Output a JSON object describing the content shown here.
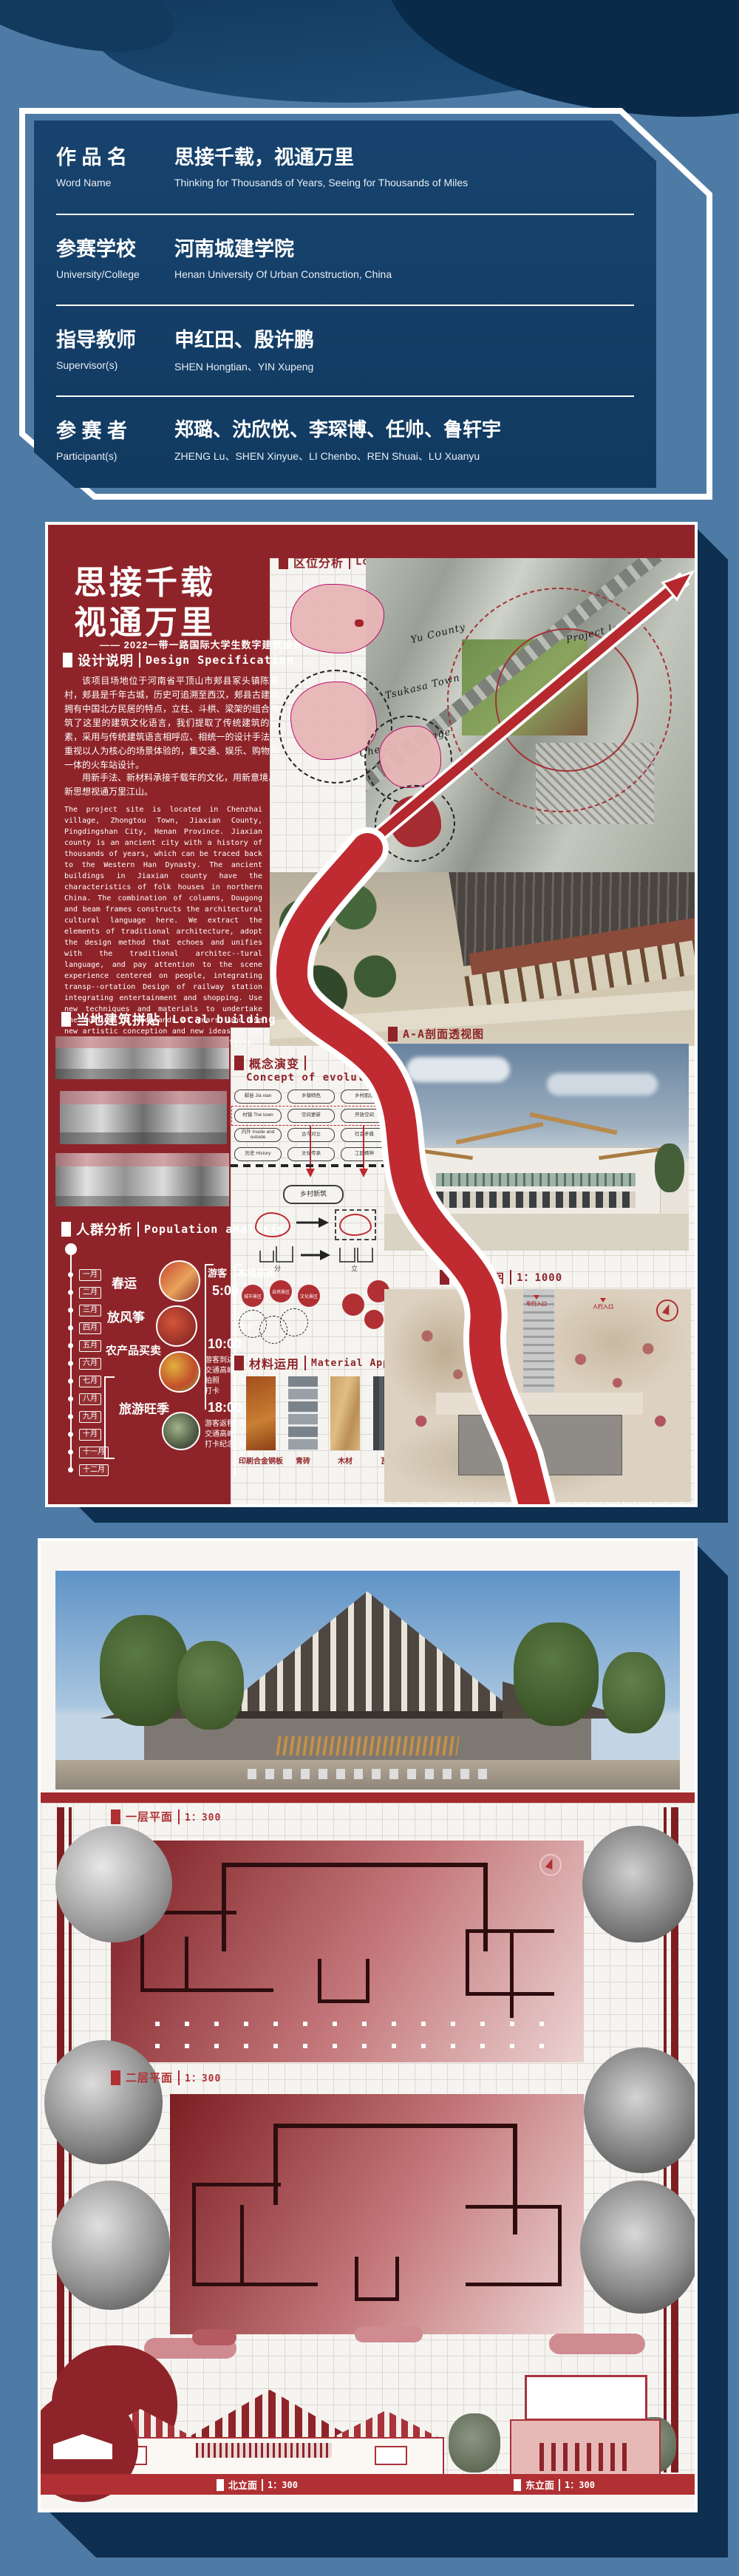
{
  "info_card": {
    "rows": [
      {
        "label_cn": "作 品 名",
        "label_en": "Word Name",
        "value_cn": "思接千载，视通万里",
        "value_en": "Thinking for Thousands of Years, Seeing for Thousands of Miles"
      },
      {
        "label_cn": "参赛学校",
        "label_en": "University/College",
        "value_cn": "河南城建学院",
        "value_en": "Henan University Of Urban Construction, China"
      },
      {
        "label_cn": "指导教师",
        "label_en": "Supervisor(s)",
        "value_cn": "申红田、殷许鹏",
        "value_en": "SHEN Hongtian、YIN Xupeng"
      },
      {
        "label_cn": "参 赛 者",
        "label_en": "Participant(s)",
        "value_cn": "郑璐、沈欣悦、李琛博、任帅、鲁轩宇",
        "value_en": "ZHENG Lu、SHEN Xinyue、LI Chenbo、REN Shuai、LU Xuanyu"
      }
    ]
  },
  "poster1": {
    "title_line1": "思接千载",
    "title_line2": "视通万里",
    "subtitle": "—— 2022一带一路国际大学生数字建筑设计竞赛",
    "design_spec": {
      "title_cn": "设计说明",
      "title_en": "Design Specification",
      "body_cn": "该项目场地位于河南省平顶山市郏县冢头镇陈寨村，郏县是千年古城，历史可追溯至西汉，郏县古建筑拥有中国北方民居的特点，立柱、斗栱、梁架的组合构筑了这里的建筑文化语言，我们提取了传统建筑的元素，采用与传统建筑语言相呼应、相统一的设计手法，重视以人为核心的场景体验的，集交通、娱乐、购物为一体的火车站设计。",
      "body_cn2": "用新手法、新材料承接千载年的文化，用新意境、新思想视通万里江山。",
      "body_en": "The project site is located in Chenzhai village, Zhongtou Town, Jiaxian County, Pingdingshan City, Henan Province. Jiaxian county is an ancient city with a history of thousands of years, which can be traced back to the Western Han Dynasty. The ancient buildings in Jiaxian county have the characteristics of folk houses in northern China. The combination of columns, Dougong and beam frames constructs the architectural cultural language here. We extract the elements of traditional architecture, adopt the design method that echoes and unifies with the traditional architec--tural language, and pay attention to the scene experience centered on people, integrating transp--ortation Design of railway station integrating entertainment and shopping. Use new techniques and materials to undertake the culture of thousands of years, and use new artistic conception and new ideas to see thousands of miles of rivers and mountains."
    },
    "location": {
      "title_cn": "区位分析",
      "title_en": "Location Analysis",
      "map_labels": [
        "Yu County",
        "Tsukasa Town",
        "Chenzhai Village",
        "Project land"
      ]
    },
    "local_building": {
      "title_cn": "当地建筑拼贴",
      "title_en": "Local building"
    },
    "population": {
      "title_cn": "人群分析",
      "title_en": "Population analysis",
      "months": [
        "一月",
        "二月",
        "三月",
        "四月",
        "五月",
        "六月",
        "七月",
        "八月",
        "九月",
        "十月",
        "十一月",
        "十二月"
      ],
      "activities": [
        "春运",
        "放风筝",
        "农产品买卖",
        "旅游旺季"
      ],
      "col_tourist": "游客",
      "col_local": "本地居民",
      "times": [
        "5:00",
        "10:00",
        "18:00"
      ],
      "t1_local": "老年人\n晨跑\n散步",
      "t2_tourist": "游客到达\n交通高峰\n拍照\n打卡",
      "t2_local": "青年人\n上班\n通勤",
      "t3_tourist": "游客返程\n交通高峰\n打卡纪念",
      "t3_local": "青年人\n下班\n餐饮\n散步"
    },
    "concept": {
      "title_cn": "概念演变",
      "title_en": "Concept of evolution",
      "boxes": [
        "郏县 Jia xian",
        "乡镇特色",
        "乡村肌理",
        "村镇 The town",
        "空间更新",
        "开放空间",
        "内外 Inside and outside",
        "古今对立",
        "社会矛盾",
        "历史 History",
        "文化传承",
        "工匠精神"
      ],
      "result": "乡村新筑",
      "glyph_labels": [
        "分",
        "立"
      ],
      "circle_labels": [
        "城市景区",
        "自然景区",
        "文化景区"
      ]
    },
    "material": {
      "title_cn": "材料运用",
      "title_en": "Material Application",
      "items": [
        "印刷合金铜板",
        "青砖",
        "木材",
        "瓦片"
      ]
    },
    "section_view": {
      "title_cn": "A-A剖面透视图"
    },
    "site_plan": {
      "title_cn": "总平面图",
      "scale": "1：1000",
      "entry_labels": [
        "人行入口",
        "车行入口",
        "人行入口"
      ]
    }
  },
  "poster2": {
    "floor1_label": "一层平面",
    "floor1_scale": "1：300",
    "floor2_label": "二层平面",
    "floor2_scale": "1：300",
    "elev_left_label": "北立面",
    "elev_left_scale": "1：300",
    "elev_right_label": "东立面",
    "elev_right_scale": "1：300"
  }
}
